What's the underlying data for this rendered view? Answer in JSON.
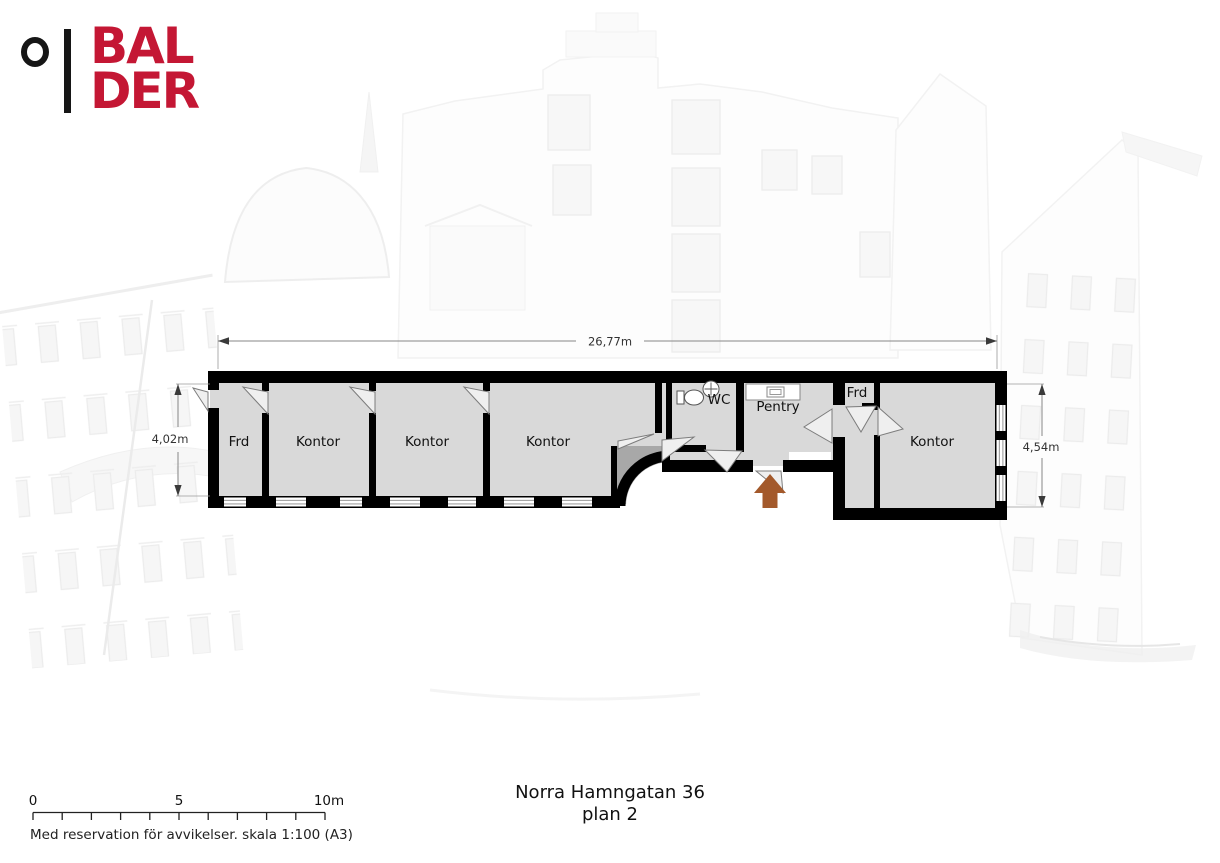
{
  "logo": {
    "line1": "BAL",
    "line2": "DER",
    "brand_red": "#c41734",
    "mark_color": "#161616"
  },
  "plan": {
    "rooms": [
      {
        "id": "frd-left",
        "label": "Frd"
      },
      {
        "id": "kontor-1",
        "label": "Kontor"
      },
      {
        "id": "kontor-2",
        "label": "Kontor"
      },
      {
        "id": "kontor-3",
        "label": "Kontor"
      },
      {
        "id": "wc",
        "label": "WC"
      },
      {
        "id": "pentry",
        "label": "Pentry"
      },
      {
        "id": "frd-right",
        "label": "Frd"
      },
      {
        "id": "kontor-4",
        "label": "Kontor"
      }
    ],
    "dimensions": {
      "total_width": "26,77m",
      "left_height": "4,02m",
      "right_height": "4,54m"
    },
    "colors": {
      "floor": "#d9d9d9",
      "wall": "#000000",
      "niche": "#a8a8a8",
      "entrance_arrow": "#a3592b"
    }
  },
  "scale_bar": {
    "label_start": "0",
    "label_mid": "5",
    "label_end": "10m"
  },
  "footer": {
    "disclaimer": "Med reservation för avvikelser. skala 1:100 (A3)",
    "address": "Norra Hamngatan 36",
    "plan_label": "plan 2"
  }
}
